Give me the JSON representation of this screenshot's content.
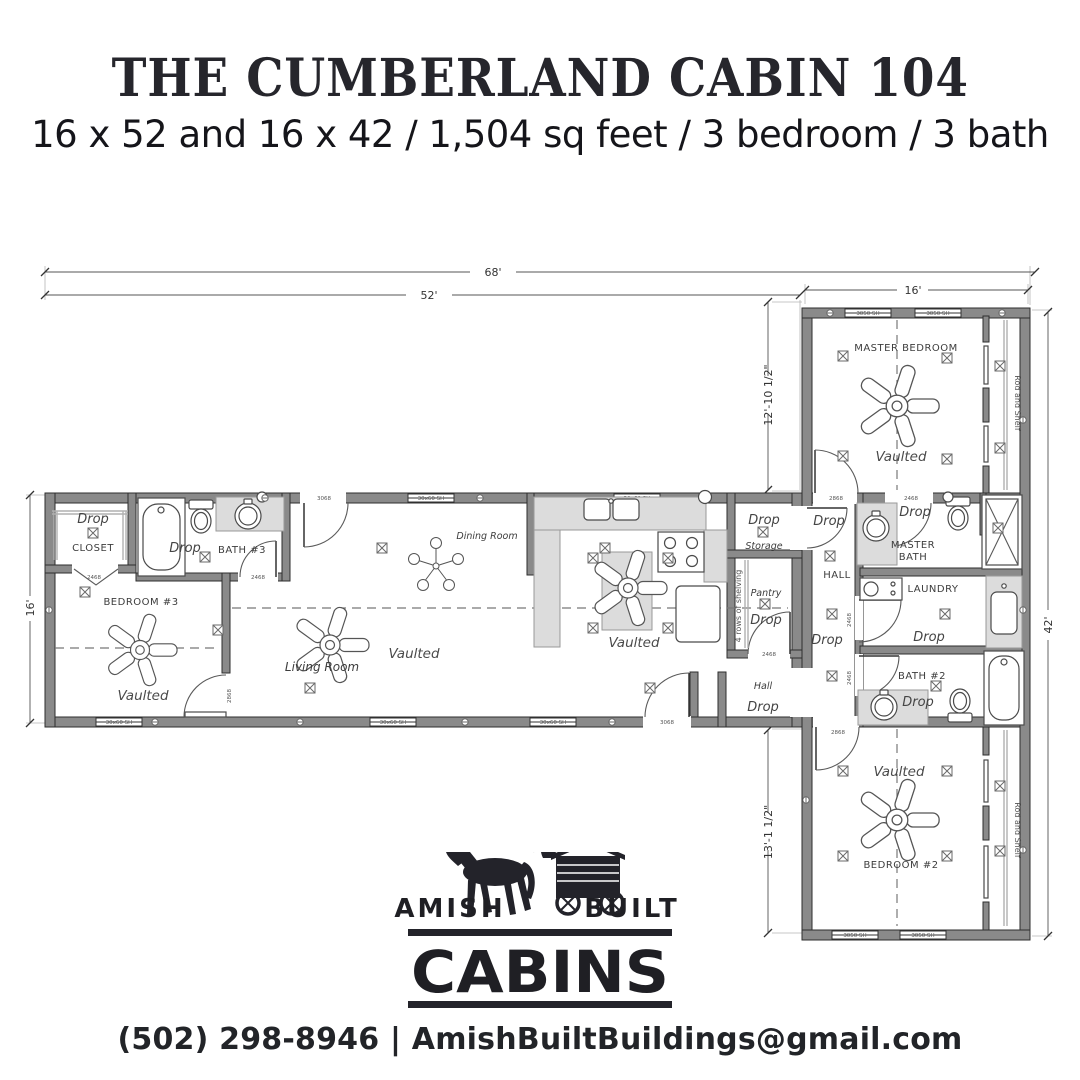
{
  "header": {
    "title": "THE CUMBERLAND CABIN 104",
    "subtitle": "16 x 52 and 16 x 42 / 1,504 sq feet / 3 bedroom / 3 bath"
  },
  "dimensions": {
    "overall_width": "68'",
    "main_width": "52'",
    "main_depth": "16'",
    "wing_width": "16'",
    "wing_upper_depth": "12'-10 1/2\"",
    "wing_lower_depth": "13'-1 1/2\"",
    "wing_length": "42'"
  },
  "rooms": {
    "closet": "CLOSET",
    "bath3": "BATH #3",
    "bedroom3": "BEDROOM #3",
    "living_room": "Living Room",
    "dining_room": "Dining Room",
    "storage": "Storage",
    "pantry": "Pantry",
    "hall_main": "Hall",
    "hall_wing": "HALL",
    "master_bedroom": "MASTER BEDROOM",
    "master_bath_line1": "MASTER",
    "master_bath_line2": "BATH",
    "laundry": "LAUNDRY",
    "bath2": "BATH #2",
    "bedroom2": "BEDROOM #2"
  },
  "annotations": {
    "drop": "Drop",
    "vaulted": "Vaulted",
    "rod_and_shelf": "Rod and Shelf",
    "shelving": "4 rows of shelving",
    "window_large": "30x60 SH",
    "window_small": "3050 SH",
    "door_exterior": "3068",
    "door_interior": "2868",
    "door_small": "2468"
  },
  "logo": {
    "amish": "AMISH",
    "built": "BUILT",
    "cabins": "CABINS"
  },
  "footer": {
    "contact": "(502) 298-8946 | AmishBuiltBuildings@gmail.com"
  }
}
